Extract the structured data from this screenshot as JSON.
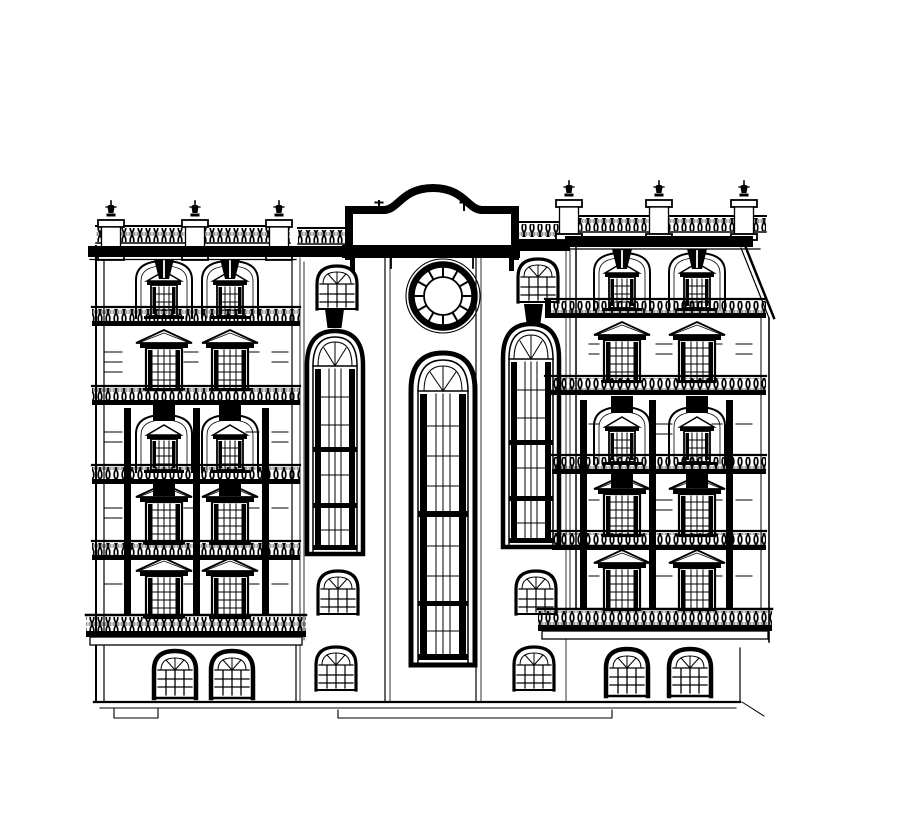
{
  "document": {
    "type": "architectural elevation drawing",
    "subject": "Black-and-white CAD front elevation of a symmetrical six-storey classical building: two window wings with balustraded balconies and pedimented windows, a central bay with an arched parapet, a twelve-spoke circular window and three tall arched windows",
    "style": "black ink line drawing on white paper, no text or dimensions shown"
  },
  "colors": {
    "ink": "#000000",
    "paper": "#ffffff"
  },
  "building": {
    "left_wing": {
      "parapet_finials": 3,
      "parapet_pedestals": 3,
      "attic_arched_windows": 2,
      "pedimented_window_rows": 4,
      "windows_per_row": 2,
      "balcony_balustrade_bands": 5,
      "dark_pilasters": 3,
      "ground_floor_arched_windows": 2
    },
    "right_wing": {
      "parapet_finials": 3,
      "parapet_pedestals": 3,
      "attic_arched_windows": 2,
      "pedimented_window_rows": 4,
      "windows_per_row": 2,
      "balcony_balustrade_bands": 5,
      "dark_pilasters": 3,
      "ground_floor_arched_windows": 2,
      "mansard_roof_edge": true
    },
    "center": {
      "arched_parapet": true,
      "parapet_finial_ticks": 2,
      "circular_window_spokes": 12,
      "tall_arched_windows": 3,
      "small_arched_windows": 6,
      "keystones": 2
    }
  }
}
